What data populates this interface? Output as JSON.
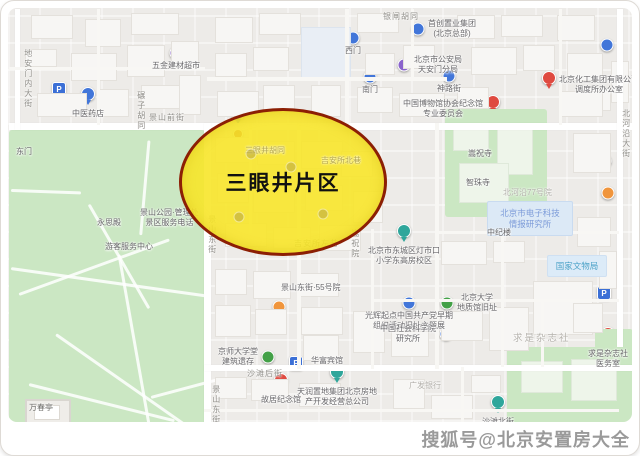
{
  "watermark": {
    "text": "搜狐号@北京安置房大全",
    "color": "#9a9a9a"
  },
  "highlight": {
    "label": "三眼井片区",
    "fill": "#f7e62a",
    "border": "#8c1f04"
  },
  "palette": {
    "blue": "#4276d9",
    "teal": "#2fa69b",
    "green": "#43a047",
    "purple": "#8a63cc",
    "orange": "#f0953c",
    "red": "#df4a40",
    "pink": "#ee6d95",
    "darkred": "#a93a2e",
    "gold": "#b9a643",
    "parking": "#3b6fd6"
  },
  "streets": [
    {
      "text": "地安门内大街",
      "x": 22,
      "y": 48,
      "v": true
    },
    {
      "text": "碾子胡同",
      "x": 135,
      "y": 90,
      "v": true
    },
    {
      "text": "景山前街",
      "x": 148,
      "y": 113
    },
    {
      "text": "银闸胡同",
      "x": 382,
      "y": 12
    },
    {
      "text": "景山东街",
      "x": 206,
      "y": 214,
      "v": true
    },
    {
      "text": "景山东街",
      "x": 210,
      "y": 384,
      "v": true
    },
    {
      "text": "北河沿大街",
      "x": 620,
      "y": 108,
      "v": true
    },
    {
      "text": "沙滩后街",
      "x": 246,
      "y": 369
    },
    {
      "text": "吉安所左巷",
      "x": 293,
      "y": 239
    },
    {
      "text": "嵩祝院",
      "x": 349,
      "y": 228,
      "v": true
    },
    {
      "text": "北河沿77号院",
      "x": 502,
      "y": 188,
      "muted": true
    },
    {
      "text": "广发银行",
      "x": 408,
      "y": 381,
      "muted": true
    },
    {
      "text": "求是杂志社",
      "x": 512,
      "y": 333,
      "big": true
    },
    {
      "text": "万春亭",
      "x": 28,
      "y": 403,
      "dark": true
    },
    {
      "text": "三眼井胡同",
      "x": 244,
      "y": 146,
      "faint": true
    },
    {
      "text": "吉安所北巷",
      "x": 320,
      "y": 156,
      "faint": true
    }
  ],
  "area_boxes": [
    {
      "x": 486,
      "y": 200,
      "w": 84,
      "h": 33,
      "fill": "#dce9f6",
      "border": "#c9dbf0",
      "color": "#7d9cd9",
      "lines": [
        "北京市电子科技",
        "情报研究所"
      ]
    },
    {
      "x": 546,
      "y": 254,
      "w": 58,
      "h": 20,
      "fill": "#dcebf8",
      "border": "#cfe0f2",
      "color": "#4ea3c8",
      "lines": [
        "国家文物局"
      ]
    }
  ],
  "pois": [
    {
      "x": 58,
      "y": 88,
      "kind": "parking"
    },
    {
      "x": 87,
      "y": 100,
      "kind": "pin",
      "color": "blue",
      "lines": [
        "中医药店"
      ]
    },
    {
      "x": 175,
      "y": 52,
      "kind": "dot",
      "color": "purple",
      "lines": [
        "五金建材超市"
      ]
    },
    {
      "x": 352,
      "y": 37,
      "kind": "dot",
      "color": "blue",
      "lines": [
        "西门"
      ]
    },
    {
      "x": 417,
      "y": 28,
      "kind": "dot",
      "color": "blue",
      "side": "right",
      "lines": [
        "首创置业集团",
        "(北京总部)"
      ]
    },
    {
      "x": 369,
      "y": 76,
      "kind": "dot",
      "color": "blue",
      "lines": [
        "南门"
      ]
    },
    {
      "x": 403,
      "y": 64,
      "kind": "dot",
      "color": "purple",
      "side": "right",
      "lines": [
        "北京市公安局",
        "天安门分局"
      ]
    },
    {
      "x": 448,
      "y": 75,
      "kind": "dot",
      "color": "blue",
      "lines": [
        "神路街"
      ]
    },
    {
      "x": 548,
      "y": 84,
      "kind": "pin",
      "color": "red",
      "side": "right",
      "lines": [
        "北京化工集团有限公司",
        "调度所办公室"
      ]
    },
    {
      "x": 606,
      "y": 44,
      "kind": "dot",
      "color": "blue"
    },
    {
      "x": 492,
      "y": 108,
      "kind": "pin",
      "color": "red",
      "side": "left",
      "lines": [
        "中国博物馆协会纪念馆",
        "专业委员会"
      ]
    },
    {
      "x": 457,
      "y": 153,
      "kind": "dot",
      "color": "teal",
      "side": "right",
      "lines": [
        "嵩祝寺"
      ]
    },
    {
      "x": 455,
      "y": 182,
      "kind": "dot",
      "color": "blue",
      "side": "right",
      "lines": [
        "智珠寺"
      ]
    },
    {
      "x": 604,
      "y": 160,
      "kind": "dot",
      "color": "blue"
    },
    {
      "x": 607,
      "y": 192,
      "kind": "dot",
      "color": "orange"
    },
    {
      "x": 498,
      "y": 219,
      "kind": "dot",
      "color": "blue",
      "lines": [
        "中纪楼"
      ]
    },
    {
      "x": 603,
      "y": 292,
      "kind": "parking"
    },
    {
      "x": 403,
      "y": 237,
      "kind": "pin",
      "color": "teal",
      "lines": [
        "北京市东城区灯市口",
        "小学东高房校区"
      ]
    },
    {
      "x": 270,
      "y": 287,
      "kind": "dot",
      "color": "blue",
      "side": "right",
      "lines": [
        "景山东街·55号院"
      ]
    },
    {
      "x": 278,
      "y": 306,
      "kind": "dot",
      "color": "orange"
    },
    {
      "x": 326,
      "y": 347,
      "kind": "dot",
      "color": "purple",
      "lines": [
        "华富宾馆"
      ]
    },
    {
      "x": 295,
      "y": 362,
      "kind": "parking"
    },
    {
      "x": 408,
      "y": 302,
      "kind": "dot",
      "color": "blue",
      "lines": [
        "光辉起点中国共产党早期",
        "组织活动旧址主题展"
      ]
    },
    {
      "x": 336,
      "y": 378,
      "kind": "pin",
      "color": "teal",
      "lines": [
        "天润置地集团北京房地",
        "产开发经营总公司"
      ]
    },
    {
      "x": 280,
      "y": 386,
      "kind": "pin",
      "color": "red",
      "lines": [
        "故居纪念馆"
      ]
    },
    {
      "x": 267,
      "y": 356,
      "kind": "dot",
      "color": "green",
      "side": "left",
      "lines": [
        "京师大学堂",
        "建筑遗存"
      ]
    },
    {
      "x": 446,
      "y": 302,
      "kind": "dot",
      "color": "green",
      "side": "right",
      "lines": [
        "北京大学",
        "地质馆旧址"
      ]
    },
    {
      "x": 445,
      "y": 333,
      "kind": "dot",
      "color": "blue",
      "side": "left",
      "lines": [
        "中国社会科学院",
        "研究所"
      ]
    },
    {
      "x": 607,
      "y": 340,
      "kind": "pin",
      "color": "red",
      "lines": [
        "求是杂志社",
        "医务室"
      ]
    },
    {
      "x": 497,
      "y": 408,
      "kind": "pin",
      "color": "teal",
      "lines": [
        "沙滩北街",
        "社区服务站"
      ]
    },
    {
      "x": 69,
      "y": 415,
      "kind": "dot",
      "color": "purple"
    },
    {
      "x": 108,
      "y": 209,
      "kind": "dot",
      "color": "orange",
      "lines": [
        "永思殿"
      ]
    },
    {
      "x": 129,
      "y": 217,
      "kind": "dot",
      "color": "red",
      "side": "right",
      "lines": [
        "景山公园·管理处",
        "景区服务电话"
      ]
    },
    {
      "x": 128,
      "y": 233,
      "kind": "dot",
      "color": "pink",
      "lines": [
        "游客服务中心"
      ]
    },
    {
      "x": 85,
      "y": 225,
      "kind": "dot",
      "color": "teal"
    },
    {
      "x": 180,
      "y": 313,
      "kind": "dot",
      "color": "orange"
    },
    {
      "x": 107,
      "y": 383,
      "kind": "dot",
      "color": "orange"
    },
    {
      "x": 188,
      "y": 398,
      "kind": "dot",
      "color": "orange"
    },
    {
      "x": 96,
      "y": 419,
      "kind": "dot",
      "color": "orange"
    },
    {
      "x": 148,
      "y": 421,
      "kind": "dot",
      "color": "orange"
    },
    {
      "x": 23,
      "y": 138,
      "kind": "pin",
      "color": "blue",
      "lines": [
        "东门"
      ]
    },
    {
      "x": 237,
      "y": 119,
      "kind": "pin",
      "color": "blue"
    },
    {
      "x": 237,
      "y": 133,
      "kind": "dot",
      "color": "darkred",
      "small": true
    },
    {
      "x": 250,
      "y": 153,
      "kind": "muted",
      "color": "gold"
    },
    {
      "x": 290,
      "y": 166,
      "kind": "muted",
      "color": "gold"
    },
    {
      "x": 238,
      "y": 216,
      "kind": "muted",
      "color": "gold"
    },
    {
      "x": 322,
      "y": 213,
      "kind": "muted",
      "color": "gold"
    }
  ]
}
